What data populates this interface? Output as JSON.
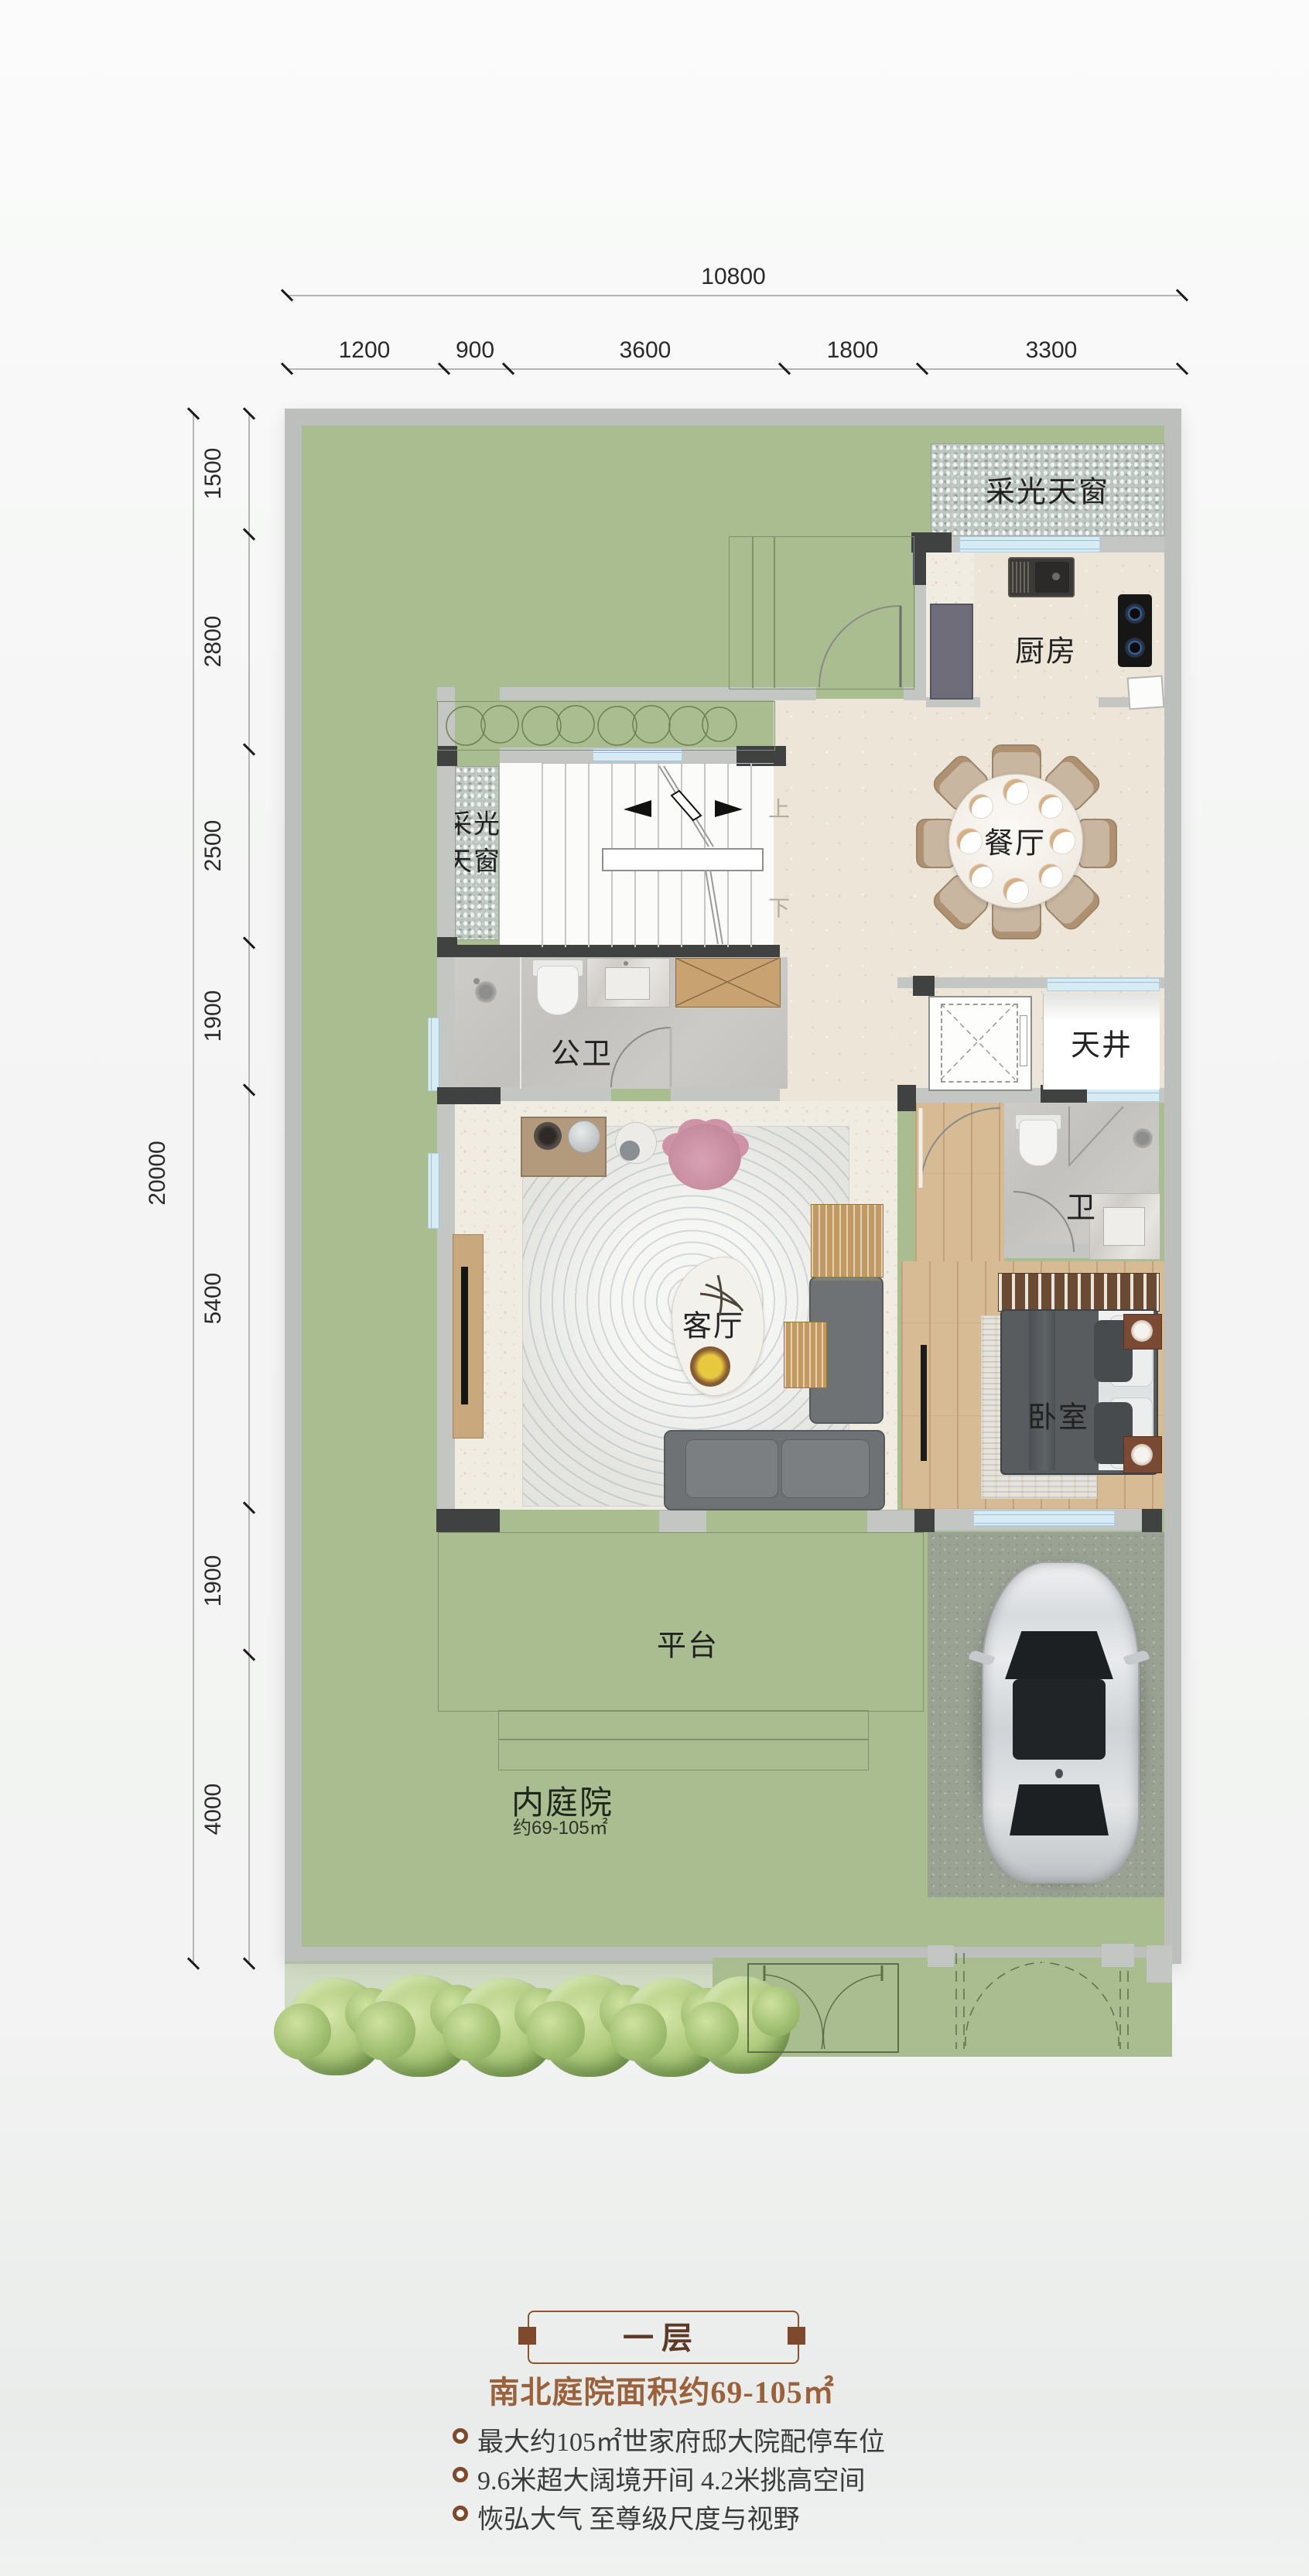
{
  "dimensions": {
    "top_total": "10800",
    "top_segments": [
      "1200",
      "900",
      "3600",
      "1800",
      "3300"
    ],
    "left_total": "20000",
    "left_segments": [
      "1500",
      "2800",
      "2500",
      "1900",
      "5400",
      "1900",
      "4000"
    ]
  },
  "rooms": {
    "skylight_top": "采光天窗",
    "kitchen": "厨房",
    "dining": "餐厅",
    "skylight_left_line1": "采光",
    "skylight_left_line2": "天窗",
    "public_bath": "公卫",
    "lightwell": "天井",
    "living": "客厅",
    "bath": "卫",
    "bedroom": "卧室",
    "terrace": "平台",
    "inner_courtyard": "内庭院",
    "courtyard_area": "约69-105㎡",
    "stair_up": "上",
    "stair_down": "下"
  },
  "caption": {
    "floor_tag": "一层",
    "headline": "南北庭院面积约69-105㎡",
    "bullets": [
      "最大约105㎡世家府邸大院配停车位",
      "9.6米超大阔境开间  4.2米挑高空间",
      "恢弘大气 至尊级尺度与视野"
    ]
  },
  "colors": {
    "courtyard_green": "#a9bd90",
    "wall_gray": "#c3c6c3",
    "wall_dark": "#3f4240",
    "window_blue": "#d7ebf4",
    "accent_brown": "#8a5530",
    "headline_brown": "#99623c"
  }
}
